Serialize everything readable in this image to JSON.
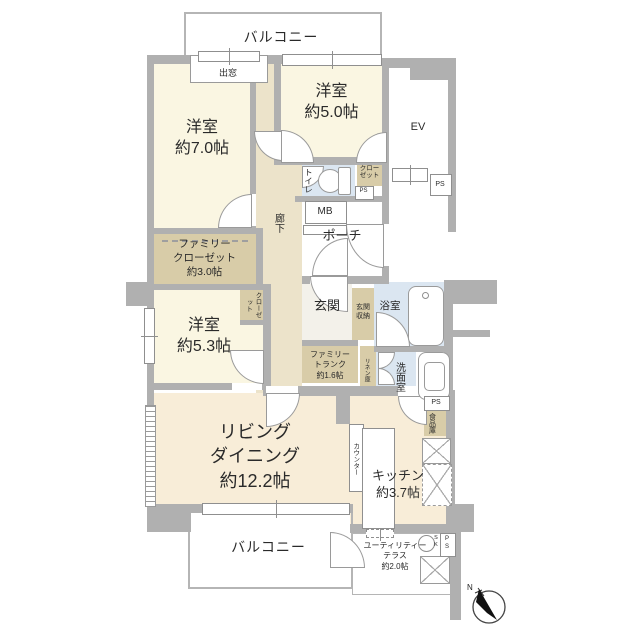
{
  "title": "マンション間取り図",
  "labels": {
    "balcony_top": "バルコニー",
    "bay_window": "出窓",
    "bedroom7": "洋室\n約7.0帖",
    "bedroom5": "洋室\n約5.0帖",
    "ev": "EV",
    "ps_ev": "PS",
    "toilet": "トイレ",
    "closet5": "クロー\nゼット",
    "ps_toilet": "PS",
    "mb": "MB",
    "porch": "ポーチ",
    "corridor": "廊下",
    "family_closet": "ファミリー\nクローゼット\n約3.0帖",
    "closet53": "クローゼット",
    "bedroom53": "洋室\n約5.3帖",
    "genkan": "玄関",
    "genkan_storage": "玄関\n収納",
    "bath": "浴室",
    "family_trunk": "ファミリー\nトランク\n約1.6帖",
    "linen": "リネン庫",
    "washroom": "洗面室",
    "ps_kitchen": "PS",
    "pantry": "食品庫",
    "living": "リビング\nダイニング\n約12.2帖",
    "counter": "カウンター",
    "kitchen": "キッチン\n約3.7帖",
    "balcony_bottom": "バルコニー",
    "utility": "ユーティリティー\nテラス\n約2.0帖",
    "sk": "S\nK",
    "ps_bottom": "P\nS",
    "compass_north": "N"
  },
  "colors": {
    "wall": "#b0b0b0",
    "bedroom_floor": "#faf6e2",
    "living_floor": "#f8edd8",
    "corridor_floor": "#ece3ca",
    "storage_floor": "#d8cca8",
    "wet_area_floor": "#dbe6f1",
    "entrance_floor": "#f3f1ea"
  }
}
